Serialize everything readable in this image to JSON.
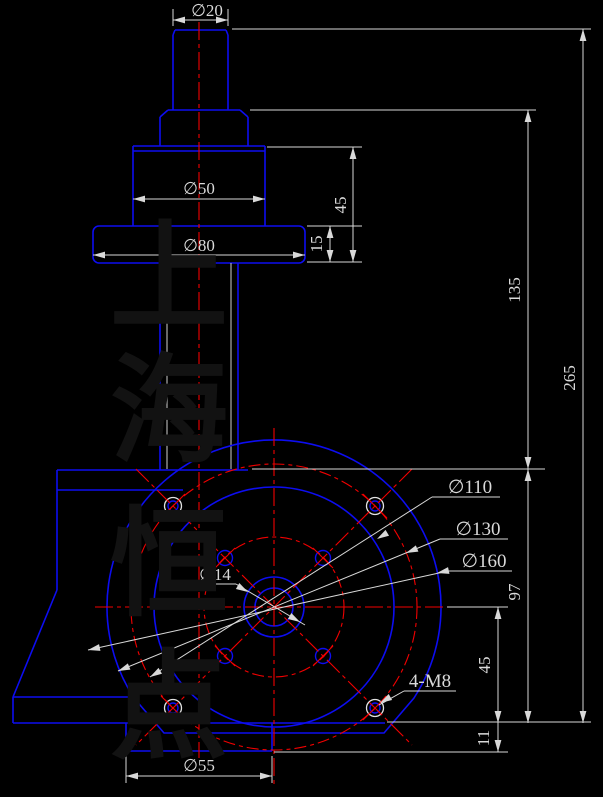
{
  "drawing": {
    "type": "cad-technical-drawing",
    "background": "#000000",
    "outline_color": "#0d0df0",
    "centerline_color": "#f20000",
    "dimension_color": "#d9d9d9",
    "watermark_color": "#121212"
  },
  "watermark": {
    "full_text": "上海恒点",
    "chars": [
      "上",
      "海",
      "恒",
      "点"
    ]
  },
  "labels": {
    "dia20": "∅20",
    "dia50": "∅50",
    "dia80": "∅80",
    "dim45_upper": "45",
    "dim15": "15",
    "dim135": "135",
    "dim265": "265",
    "dim97": "97",
    "dim45_lower": "45",
    "dim11": "11",
    "dia55": "∅55",
    "dia110": "∅110",
    "dia130": "∅130",
    "dia160": "∅160",
    "dia14": "∅14",
    "thread_callout": "4-M8"
  }
}
